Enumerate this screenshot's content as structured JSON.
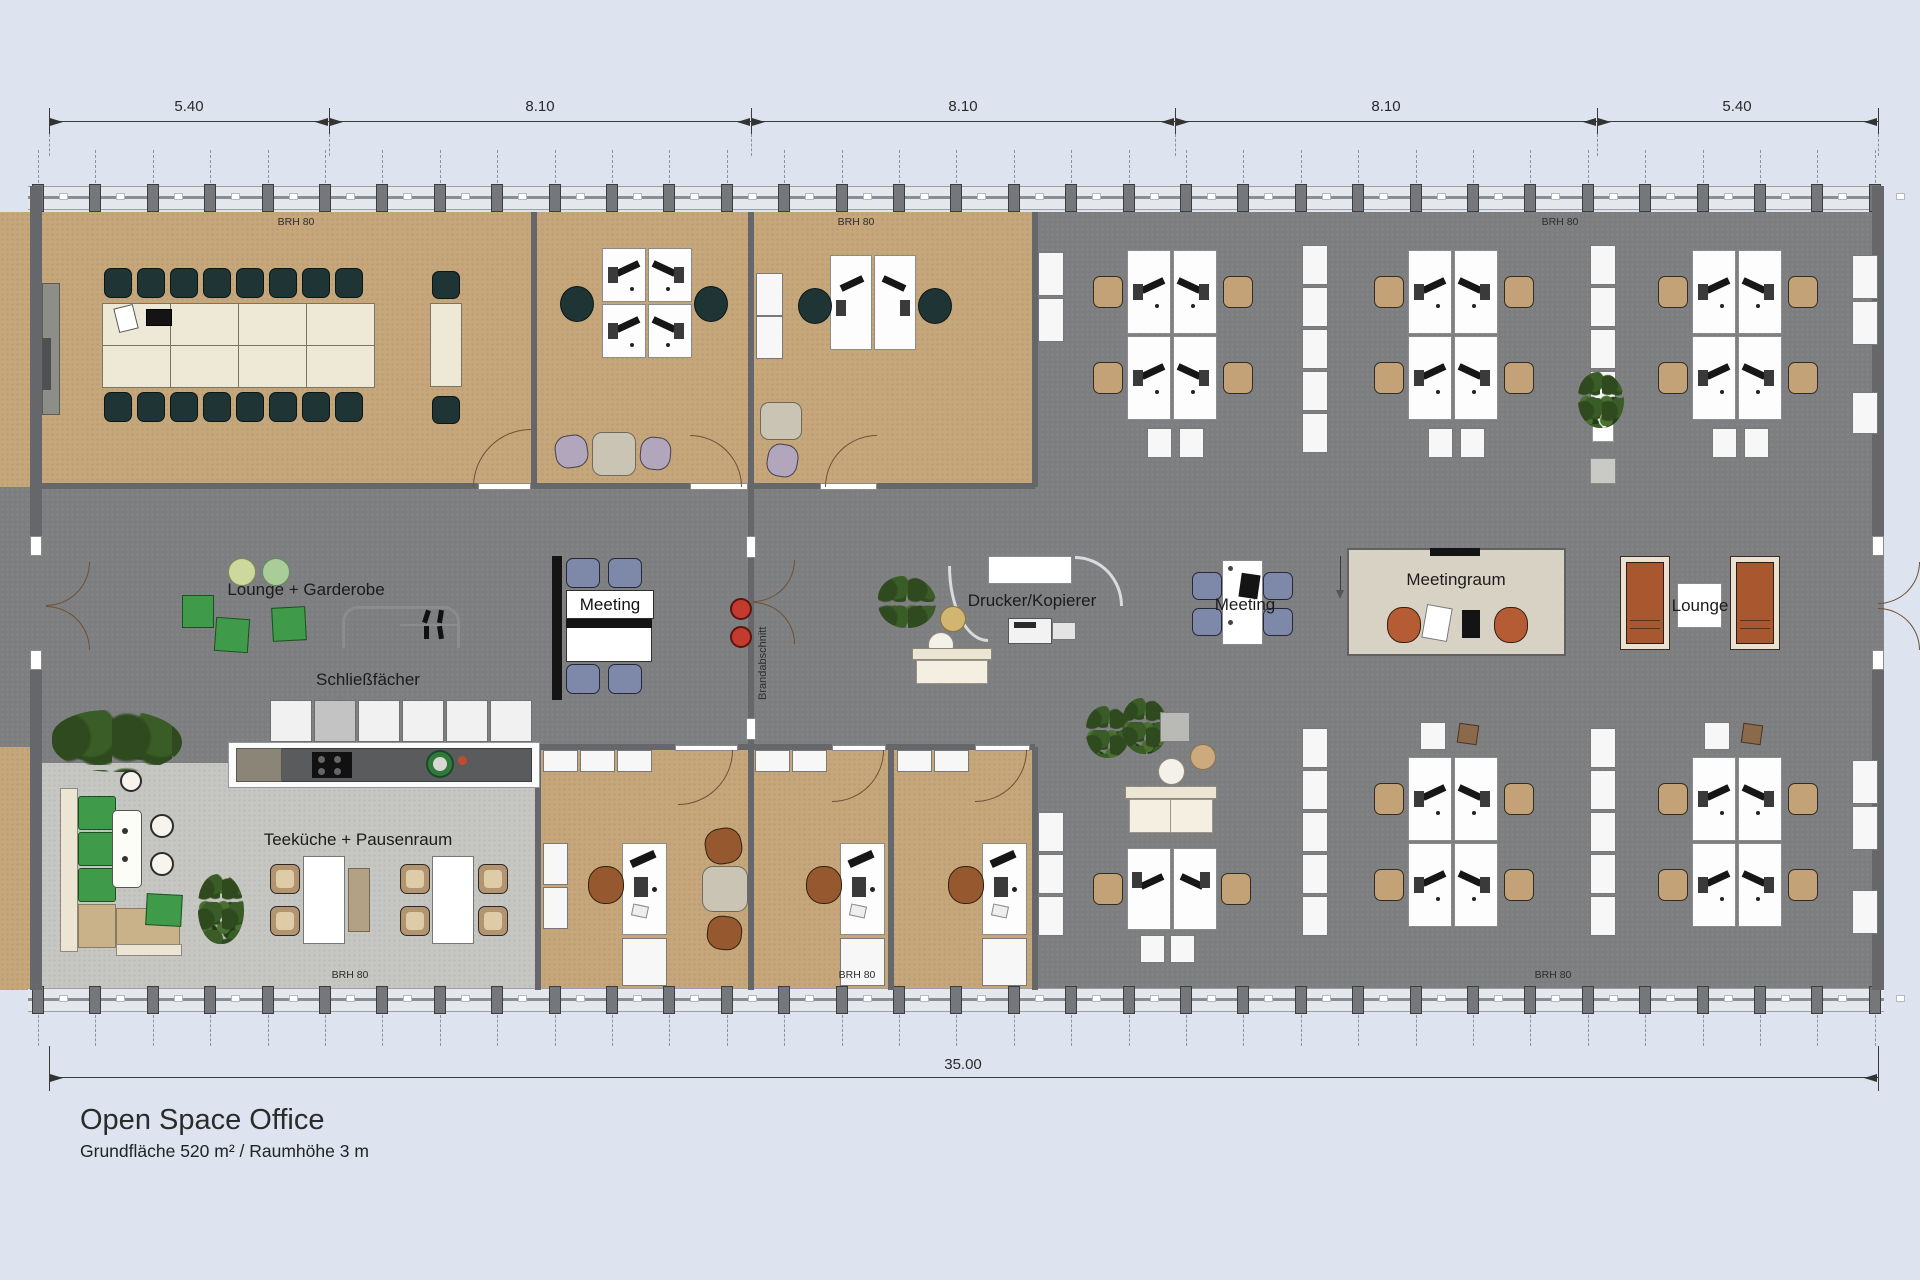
{
  "title": {
    "heading": "Open Space Office",
    "subtitle": "Grundfläche 520 m² / Raumhöhe 3 m"
  },
  "dimensions": {
    "top": [
      "5.40",
      "8.10",
      "8.10",
      "8.10",
      "5.40"
    ],
    "bottom_total": "35.00"
  },
  "labels": {
    "lounge_garderobe": "Lounge + Garderobe",
    "schliessfaecher": "Schließfächer",
    "meeting_left": "Meeting",
    "drucker_kopierer": "Drucker/Kopierer",
    "meeting_center": "Meeting",
    "meetingraum": "Meetingraum",
    "lounge_right": "Lounge",
    "teekueche": "Teeküche + Pausenraum",
    "brandabschnitt": "Brandabschnitt",
    "brh": "BRH 80"
  },
  "colors": {
    "background": "#dde4f0",
    "floor_carpet_beige": "#c6a77c",
    "floor_open_space_gray": "#7d7e80",
    "floor_kitchen_light": "#c6c6c2",
    "wall_gray": "#66676a",
    "chair_conference_dark": "#1f3535",
    "chair_task_tan": "#c4a277",
    "chair_meeting_blue": "#7e88a8",
    "sofa_lounge_rust": "#a9572e",
    "pouf_green": "#3f9a49",
    "accent_red_stools": "#c23b2e",
    "meetingraum_table": "#d8d2c5"
  }
}
